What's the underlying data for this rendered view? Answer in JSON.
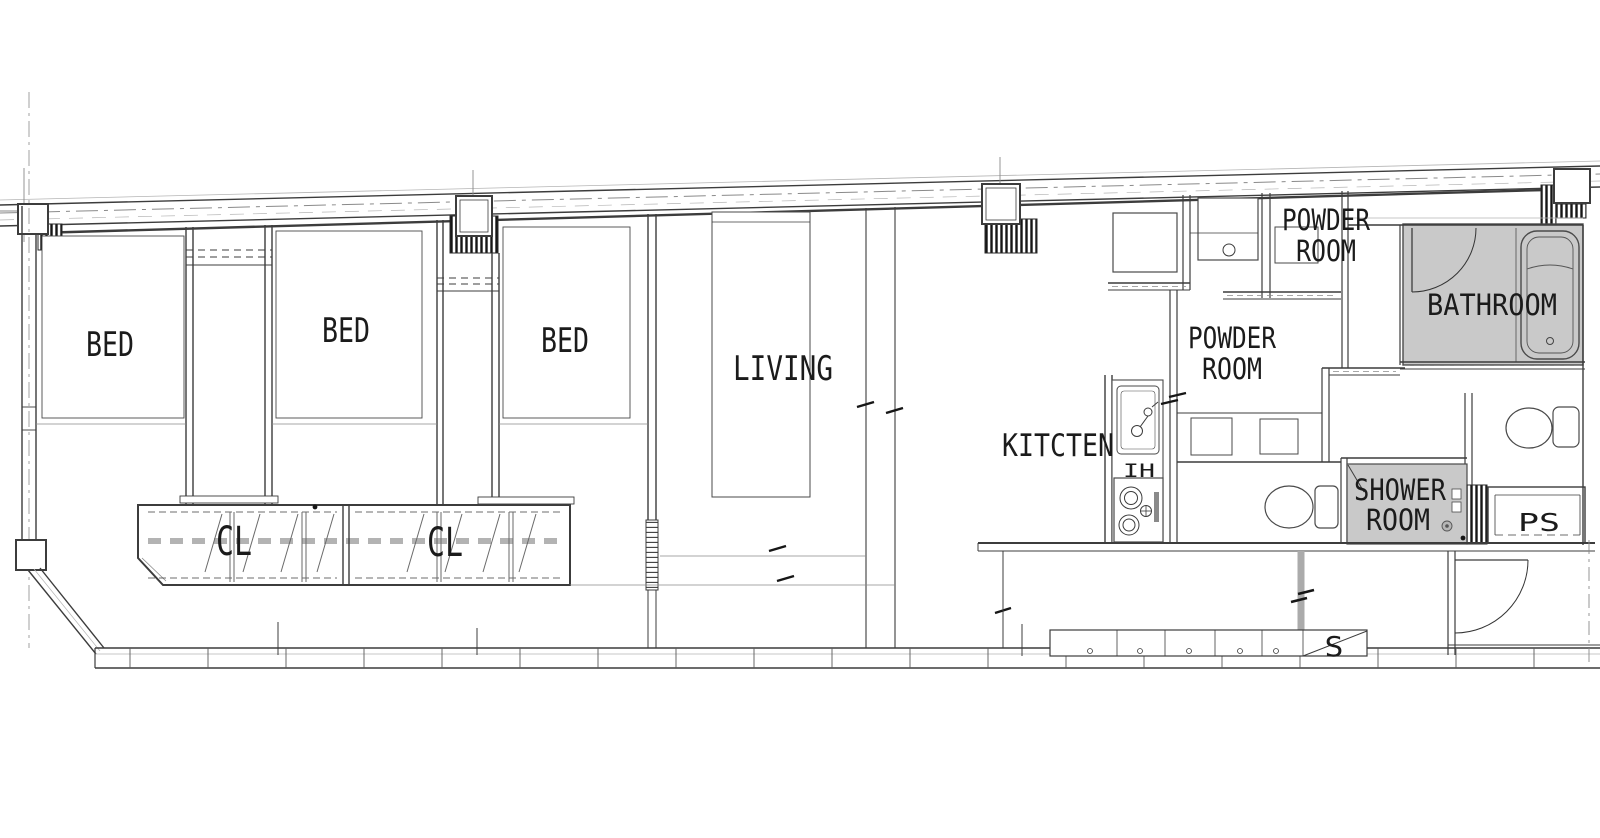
{
  "page": {
    "background": "#ffffff",
    "line_color": "#3c3c3c",
    "room_fill_gray": "#c9c9c9",
    "text_color": "#1b1b1b"
  },
  "plan": {
    "labels": {
      "bed_1": "BED",
      "bed_2": "BED",
      "bed_3": "BED",
      "living": "LIVING",
      "closet_1": "CL",
      "closet_2": "CL",
      "kitchen": "KITCTEN",
      "ih_cooktop": "IH",
      "powder_room_1": [
        "POWDER",
        "ROOM"
      ],
      "powder_room_2": [
        "POWDER",
        "ROOM"
      ],
      "bathroom": "BATHROOM",
      "shower_room": [
        "SHOWER",
        "ROOM"
      ],
      "pipe_space": "PS",
      "storage": "S"
    }
  }
}
